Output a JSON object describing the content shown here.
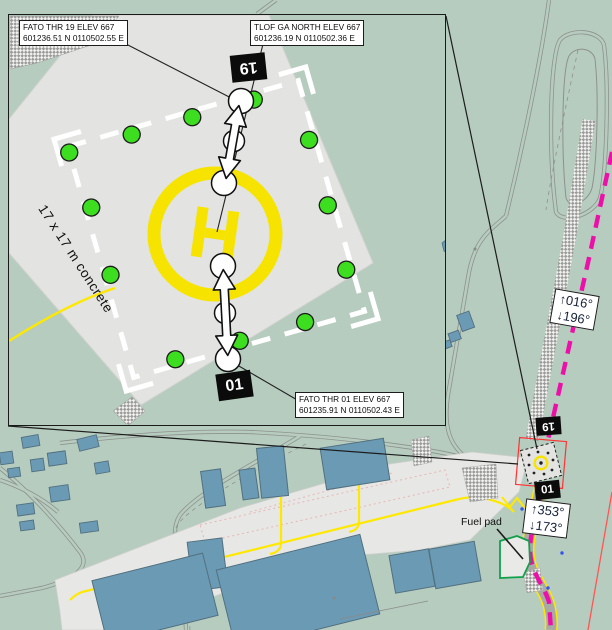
{
  "inset": {
    "labels": {
      "fato_thr_19_line1": "FATO THR 19 ELEV 667",
      "fato_thr_19_line2": "601236.51 N 0110502.55 E",
      "tlof_line1": "TLOF GA NORTH ELEV 667",
      "tlof_line2": "601236.19 N 0110502.36 E",
      "fato_thr_01_line1": "FATO THR 01 ELEV 667",
      "fato_thr_01_line2": "601235.91 N 0110502.43 E"
    },
    "surface_label": "17 x 17 m concrete",
    "thr19_badge": "19",
    "thr01_badge": "01",
    "helipad_letter": "H"
  },
  "map": {
    "north_bearing_up": "↑016°",
    "north_bearing_down": "↓196°",
    "south_bearing_up": "↑353°",
    "south_bearing_down": "↓173°",
    "thr19_badge": "19",
    "thr01_badge": "01",
    "fuel_pad_label": "Fuel pad"
  },
  "colors": {
    "map_green": "#b6ccbf",
    "concrete_gray": "#e3e3e1",
    "apron_gray": "#e7e7e5",
    "building_blue": "#6b9ab5",
    "taxiline_yellow": "#ffe800",
    "helipad_yellow": "#f6e400",
    "light_green": "#3ddd1f",
    "route_magenta": "#ec0fa8",
    "boundary_red": "#ff5555"
  }
}
